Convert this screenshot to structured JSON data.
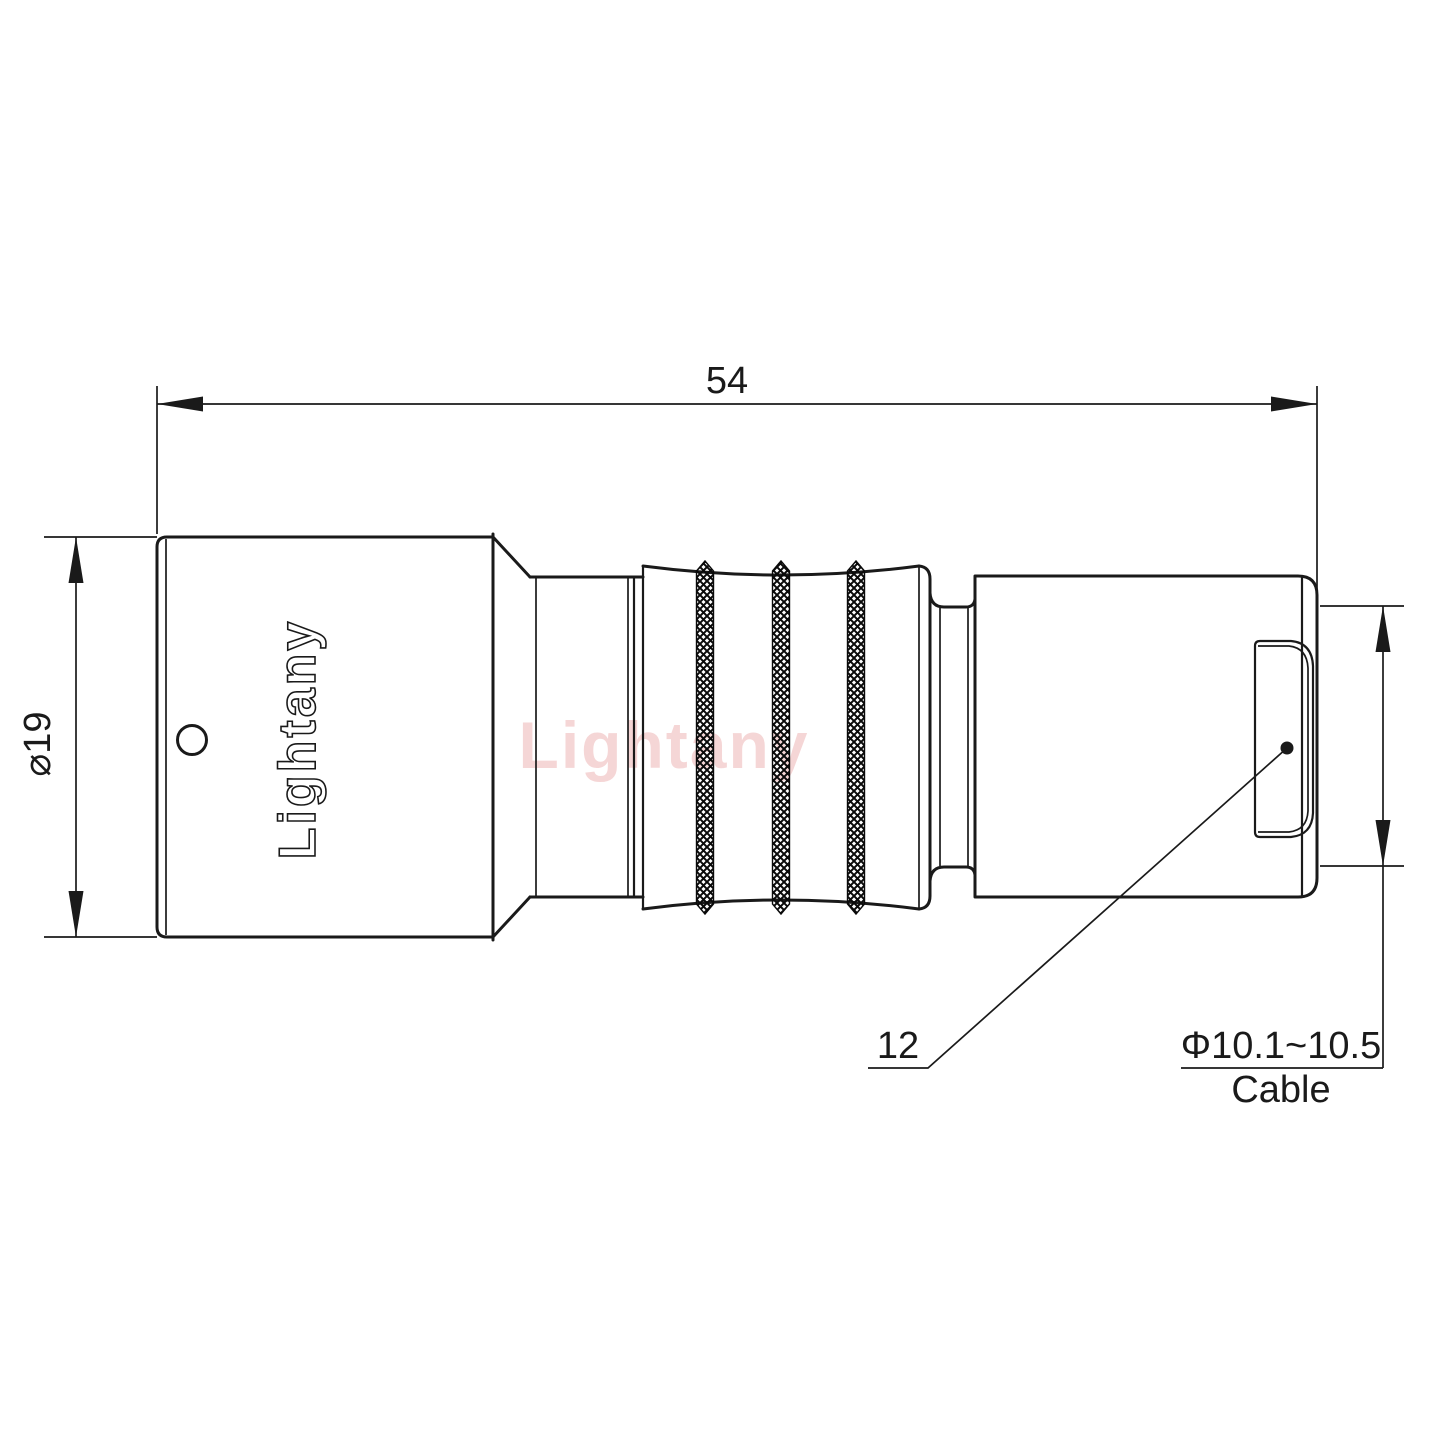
{
  "drawing": {
    "watermark_text": "Lightany",
    "engraving_text": "Lightany",
    "dimensions": {
      "overall_length": "54",
      "body_diameter": "⌀19",
      "backnut_ref": "12",
      "cable_range": "Φ10.1~10.5",
      "cable_label": "Cable"
    },
    "colors": {
      "line": "#1a1a1a",
      "background": "#ffffff",
      "watermark": "#e9a0a0"
    }
  }
}
